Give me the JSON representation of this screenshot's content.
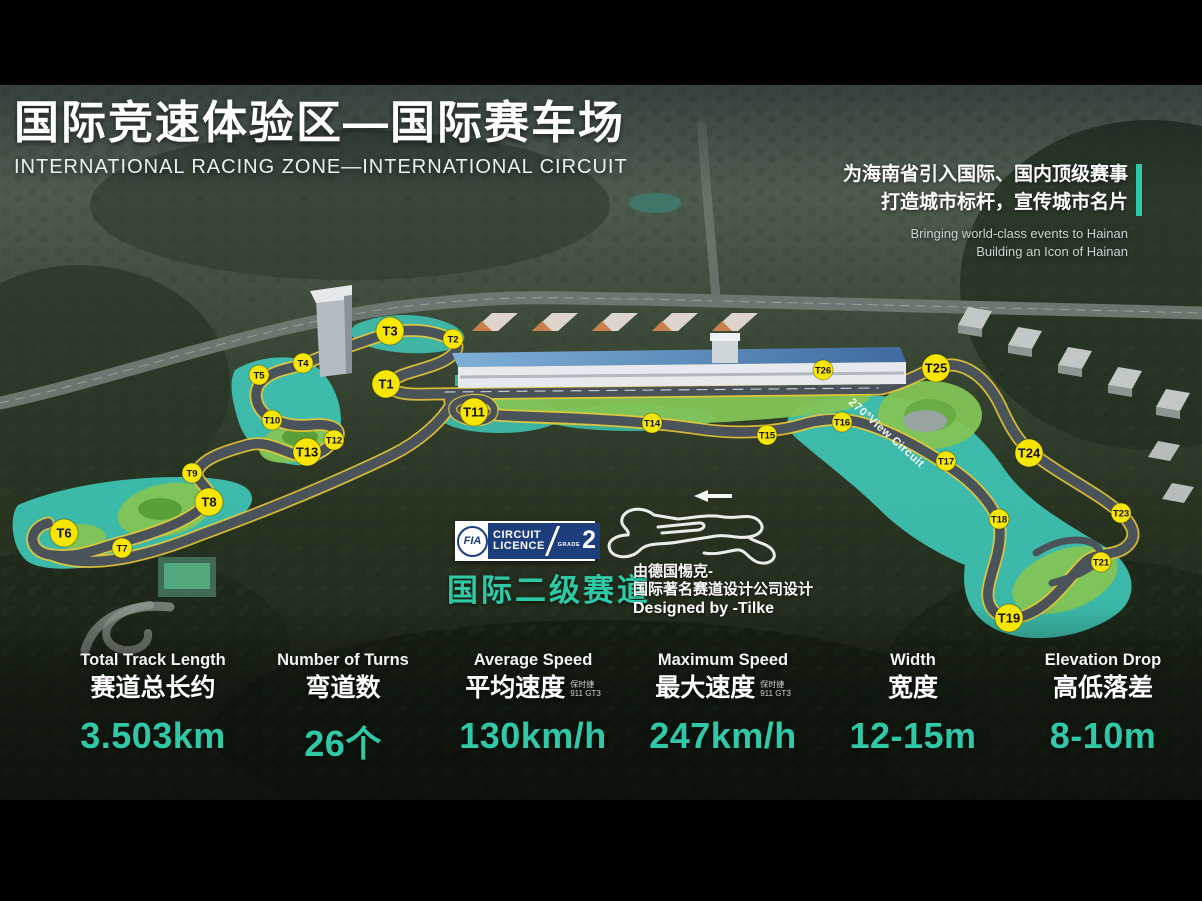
{
  "slide": {
    "title_zh": "国际竞速体验区—国际赛车场",
    "title_en": "INTERNATIONAL RACING ZONE—INTERNATIONAL CIRCUIT"
  },
  "tagline": {
    "zh_line1": "为海南省引入国际、国内顶级赛事",
    "zh_line2": "打造城市标杆，宣传城市名片",
    "en_line1": "Bringing world-class events to Hainan",
    "en_line2": "Building an Icon of Hainan"
  },
  "fia_badge": {
    "org": "FIA",
    "line1": "CIRCUIT",
    "line2": "LICENCE",
    "grade_label": "GRADE",
    "grade_value": "2"
  },
  "licence": {
    "grade_zh": "国际二级赛道",
    "designer_zh1": "由德国惕克-",
    "designer_zh2": "国际著名赛道设计公司设计",
    "designer_en": "Designed by -Tilke"
  },
  "track_map": {
    "view_label": "270°View Circuit",
    "turn_markers": [
      {
        "label": "T1",
        "x": 386,
        "y": 299,
        "size": "large"
      },
      {
        "label": "T2",
        "x": 453,
        "y": 254,
        "size": "small"
      },
      {
        "label": "T3",
        "x": 390,
        "y": 246,
        "size": "large"
      },
      {
        "label": "T4",
        "x": 303,
        "y": 278,
        "size": "small"
      },
      {
        "label": "T5",
        "x": 259,
        "y": 290,
        "size": "small"
      },
      {
        "label": "T6",
        "x": 64,
        "y": 448,
        "size": "large"
      },
      {
        "label": "T7",
        "x": 122,
        "y": 463,
        "size": "small"
      },
      {
        "label": "T8",
        "x": 209,
        "y": 417,
        "size": "large"
      },
      {
        "label": "T9",
        "x": 192,
        "y": 388,
        "size": "small"
      },
      {
        "label": "T10",
        "x": 272,
        "y": 335,
        "size": "small"
      },
      {
        "label": "T11",
        "x": 474,
        "y": 327,
        "size": "large"
      },
      {
        "label": "T12",
        "x": 334,
        "y": 355,
        "size": "small"
      },
      {
        "label": "T13",
        "x": 307,
        "y": 367,
        "size": "large"
      },
      {
        "label": "T14",
        "x": 652,
        "y": 338,
        "size": "small"
      },
      {
        "label": "T15",
        "x": 767,
        "y": 350,
        "size": "small"
      },
      {
        "label": "T16",
        "x": 842,
        "y": 337,
        "size": "small"
      },
      {
        "label": "T17",
        "x": 946,
        "y": 376,
        "size": "small"
      },
      {
        "label": "T18",
        "x": 999,
        "y": 434,
        "size": "small"
      },
      {
        "label": "T19",
        "x": 1009,
        "y": 533,
        "size": "large"
      },
      {
        "label": "T21",
        "x": 1101,
        "y": 477,
        "size": "small"
      },
      {
        "label": "T23",
        "x": 1121,
        "y": 428,
        "size": "small"
      },
      {
        "label": "T24",
        "x": 1029,
        "y": 368,
        "size": "large"
      },
      {
        "label": "T25",
        "x": 936,
        "y": 283,
        "size": "large"
      },
      {
        "label": "T26",
        "x": 823,
        "y": 285,
        "size": "small"
      }
    ]
  },
  "stats": [
    {
      "label_en": "Total Track Length",
      "label_zh": "赛道总长约",
      "value": "3.503km"
    },
    {
      "label_en": "Number of Turns",
      "label_zh": "弯道数",
      "value": "26个"
    },
    {
      "label_en": "Average Speed",
      "label_zh": "平均速度",
      "note": [
        "保时捷",
        "911 GT3"
      ],
      "value": "130km/h"
    },
    {
      "label_en": "Maximum Speed",
      "label_zh": "最大速度",
      "note": [
        "保时捷",
        "911 GT3"
      ],
      "value": "247km/h"
    },
    {
      "label_en": "Width",
      "label_zh": "宽度",
      "value": "12-15m"
    },
    {
      "label_en": "Elevation Drop",
      "label_zh": "高低落差",
      "value": "8-10m"
    }
  ],
  "colors": {
    "accent_teal": "#2fc9a8",
    "marker_yellow": "#f7e600",
    "track_runoff_teal": "#3fc9b8",
    "infield_green": "#82c455",
    "asphalt": "#4a525a"
  }
}
